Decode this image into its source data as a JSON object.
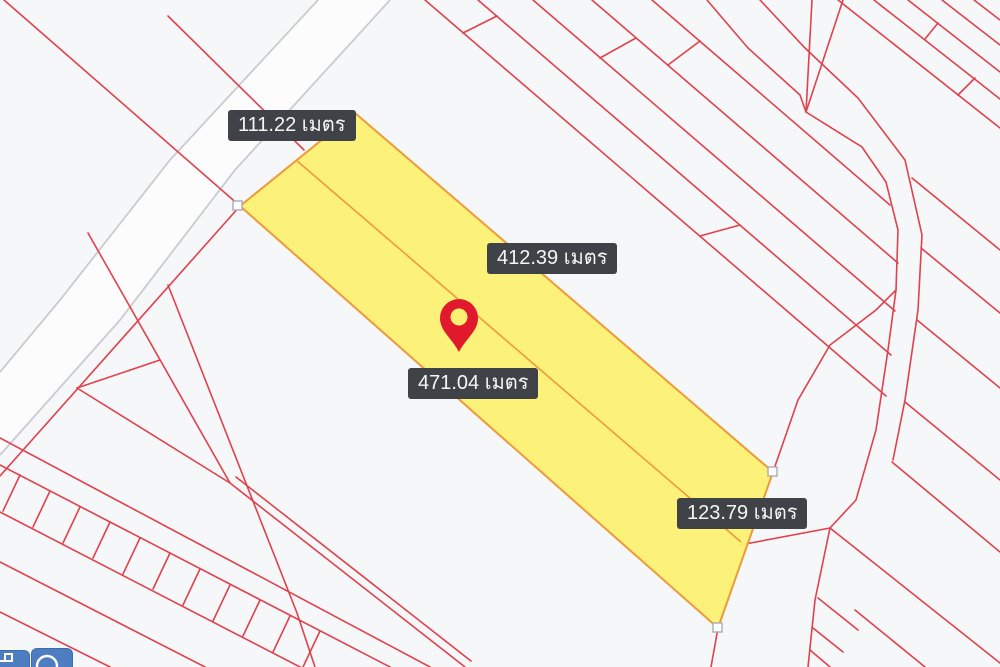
{
  "colors": {
    "bg": "#f6f7f8",
    "parcel-red": "#e0414d",
    "road-gray": "#c8cbd0",
    "road-fill": "#fcfcfd",
    "hl-yellow": "#fcf172",
    "hl-orange": "#ef9a3a",
    "label-bg": "#3f4347",
    "label-text": "#f5f6f6",
    "marker-red": "#e0192d",
    "button-blue": "#4e7dc1",
    "button-border": "#3d6cb0",
    "vertex-fill": "#ffffff",
    "vertex-border": "#a9adb3"
  },
  "map": {
    "type": "cadastral-parcel-map",
    "measurement_labels": [
      {
        "text": "111.22 เมตร",
        "value": 111.22,
        "unit": "เมตร"
      },
      {
        "text": "412.39 เมตร",
        "value": 412.39,
        "unit": "เมตร"
      },
      {
        "text": "471.04 เมตร",
        "value": 471.04,
        "unit": "เมตร"
      },
      {
        "text": "123.79 เมตร",
        "value": 123.79,
        "unit": "เมตร"
      }
    ],
    "highlighted_parcel": {
      "fill_color": "#fcf172",
      "outline_color": "#ef9a3a",
      "vertex_handles": 3
    },
    "marker": {
      "kind": "location-pin",
      "color": "#e0192d"
    }
  },
  "toolbar": {
    "buttons": [
      {
        "icon": "measure-line-icon"
      },
      {
        "icon": "measure-circle-icon"
      }
    ]
  }
}
